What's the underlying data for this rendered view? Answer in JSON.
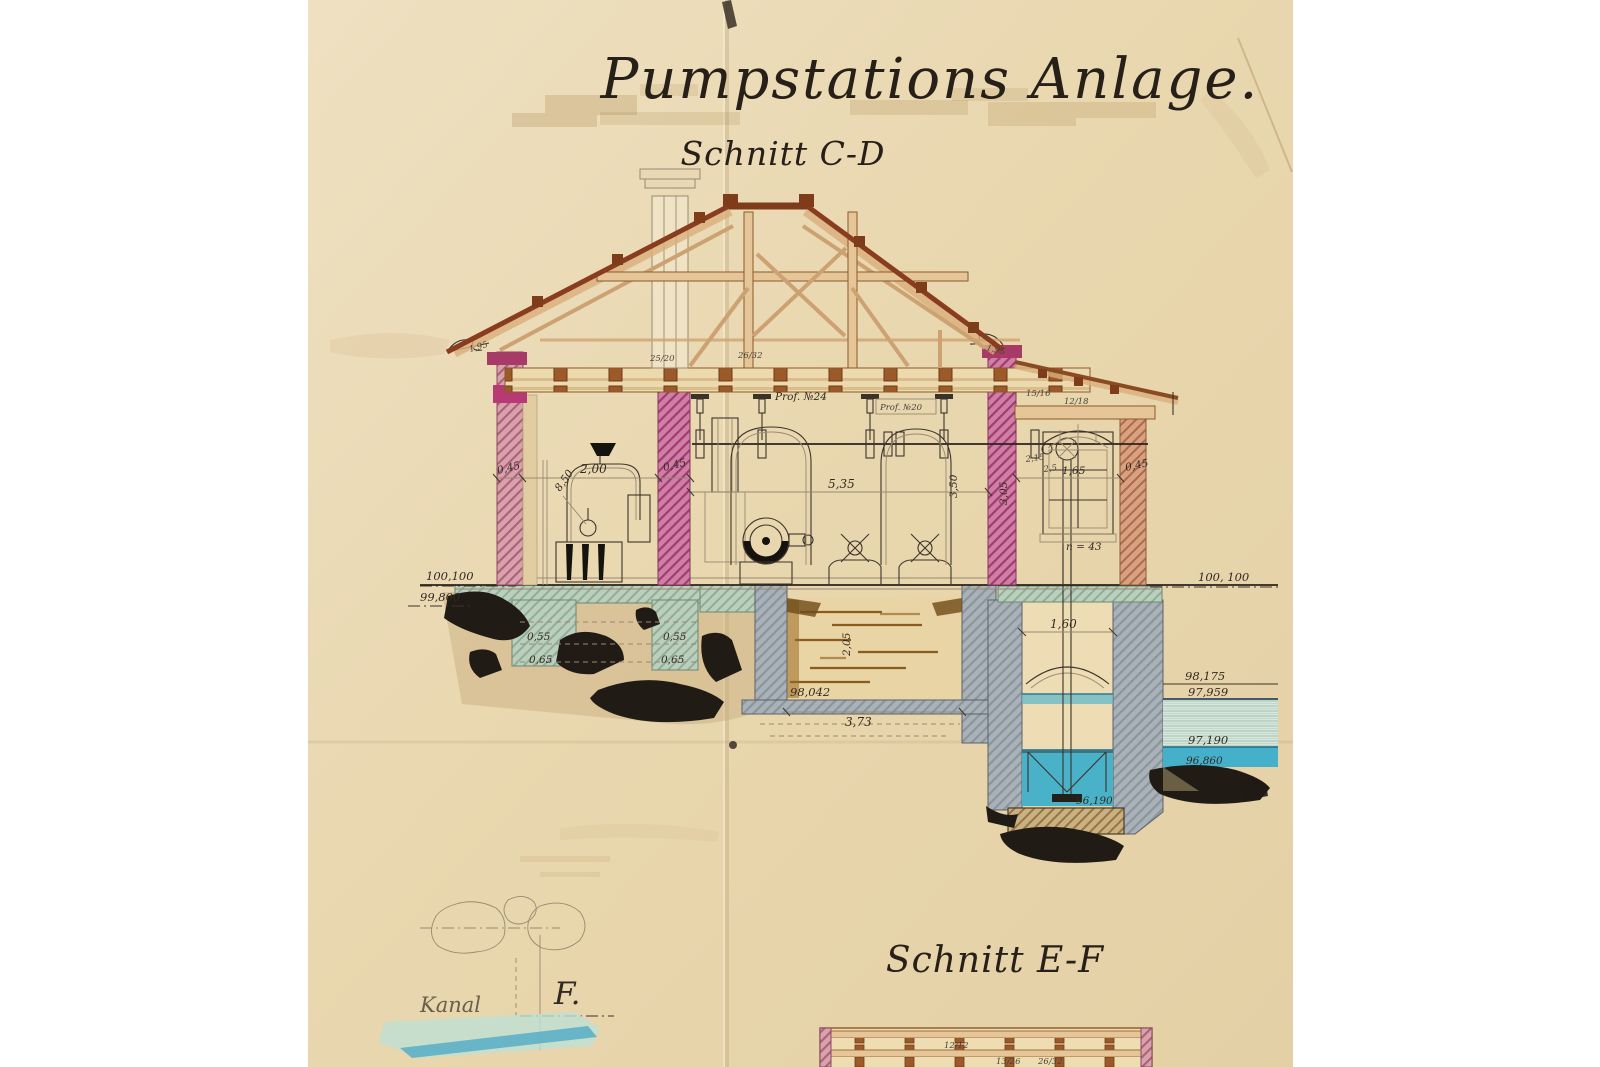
{
  "document": {
    "title": "Pumpstations Anlage.",
    "section_cd": "Schnitt C-D",
    "section_ef": "Schnitt E-F",
    "kanal_label": "Kanal",
    "f_mark": "F."
  },
  "annotations": {
    "prof24": "Prof. №24",
    "prof20": "Prof. №20",
    "n_panes": "n = 43",
    "cornice_left": "1,95",
    "cornice_right": "1,95"
  },
  "dimensions": {
    "wall_left": "0,45",
    "boiler_span": "2,00",
    "boiler_rise": "8,50",
    "wall_inner": "0,45",
    "hall_width": "5,35",
    "hall_height": "3,50",
    "annex_top": "2,15",
    "annex_mid": "2,5",
    "window_width": "1,65",
    "annex_wall": "0,45",
    "annex_height": "3,05",
    "footing_left_a": "0,55",
    "footing_left_b": "0,65",
    "footing_mid_a": "0,55",
    "footing_mid_b": "0,65",
    "pit_width": "3,73",
    "pit_depth": "2,05",
    "well_width": "1,60"
  },
  "levels": {
    "ground_left": "100,100",
    "ground_left_lower": "99,800",
    "ground_right": "100, 100",
    "pit_floor": "98,042",
    "well_floor": "96,190",
    "water_high": "98,175",
    "water_mid": "97,959",
    "water_low": "97,190",
    "water_bottom": "96,860"
  },
  "timber_marks": {
    "ceiling_a": "25/20",
    "ceiling_b": "26/32",
    "leanto_a": "15/16",
    "leanto_b": "12/18",
    "ef_a": "12/12",
    "ef_b": "13/26",
    "ef_c": "26/32"
  },
  "palette": {
    "paper": "#ead9b2",
    "ink": "#2e2822",
    "masonry_pink": "#c05187",
    "wood_tan": "#e6c698",
    "wood_brown": "#8a4a22",
    "foundation_green": "#b2c8b6",
    "concrete_gray": "#9fa9b0",
    "water_blue": "#4ab0c6",
    "wash_brown": "#b98e4a"
  }
}
